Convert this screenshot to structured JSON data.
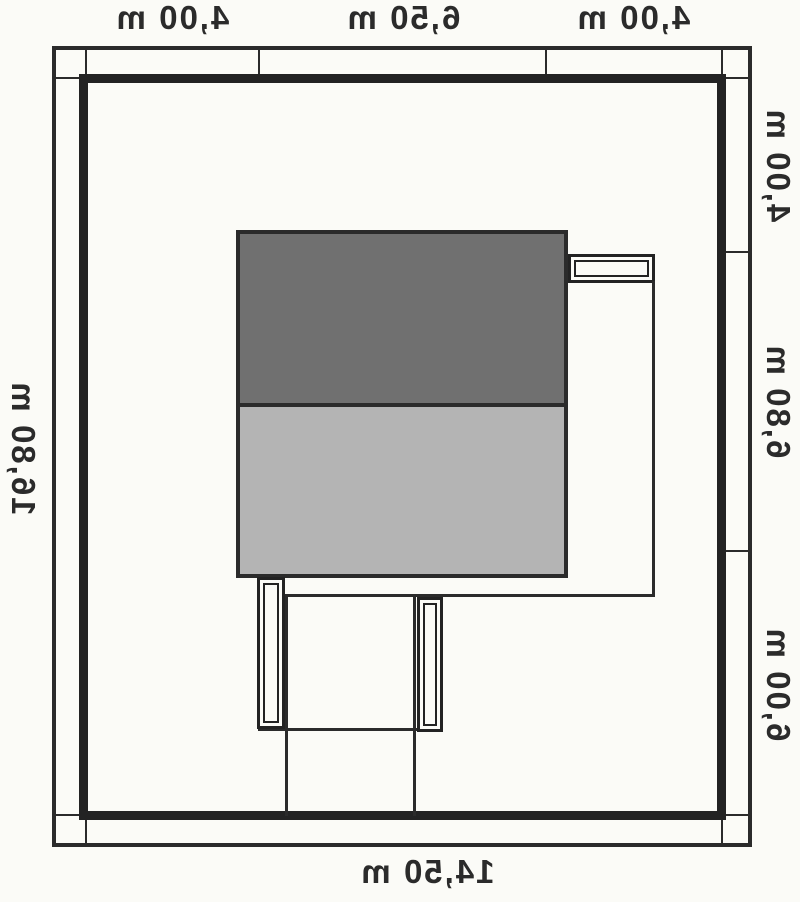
{
  "dimensions": {
    "top_segments": [
      "4,00 m",
      "6,50 m",
      "4,00 m"
    ],
    "right_segments": [
      "4,00 m",
      "6,80 m",
      "6,00 m"
    ],
    "left_total": "16,80 m",
    "bottom_total": "14,50 m"
  },
  "theme": {
    "bg": "#fbfbf7",
    "line": "#2b2b2b",
    "line_strong": "#232323",
    "roof_dark": "#707070",
    "roof_light": "#b4b4b4",
    "text": "#2b2b2b"
  }
}
